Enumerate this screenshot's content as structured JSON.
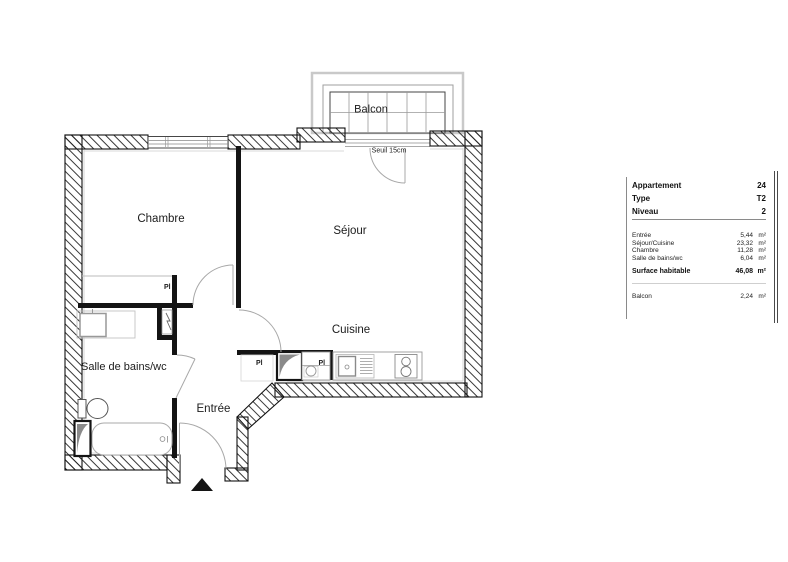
{
  "plan": {
    "rooms": {
      "balcon": "Balcon",
      "chambre": "Chambre",
      "sejour": "Séjour",
      "cuisine": "Cuisine",
      "salle_de_bains": "Salle de bains/wc",
      "entree": "Entrée"
    },
    "annotations": {
      "seuil": "Seuil 15cm",
      "placard": "Pl"
    }
  },
  "panel": {
    "header": [
      {
        "label": "Appartement",
        "value": "24"
      },
      {
        "label": "Type",
        "value": "T2"
      },
      {
        "label": "Niveau",
        "value": "2"
      }
    ],
    "areas": [
      {
        "label": "Entrée",
        "value": "5,44",
        "unit": "m²"
      },
      {
        "label": "Séjour/Cuisine",
        "value": "23,32",
        "unit": "m²"
      },
      {
        "label": "Chambre",
        "value": "11,28",
        "unit": "m²"
      },
      {
        "label": "Salle de bains/wc",
        "value": "6,04",
        "unit": "m²"
      }
    ],
    "total": {
      "label": "Surface habitable",
      "value": "46,08",
      "unit": "m²"
    },
    "balcony": {
      "label": "Balcon",
      "value": "2,24",
      "unit": "m²"
    }
  }
}
